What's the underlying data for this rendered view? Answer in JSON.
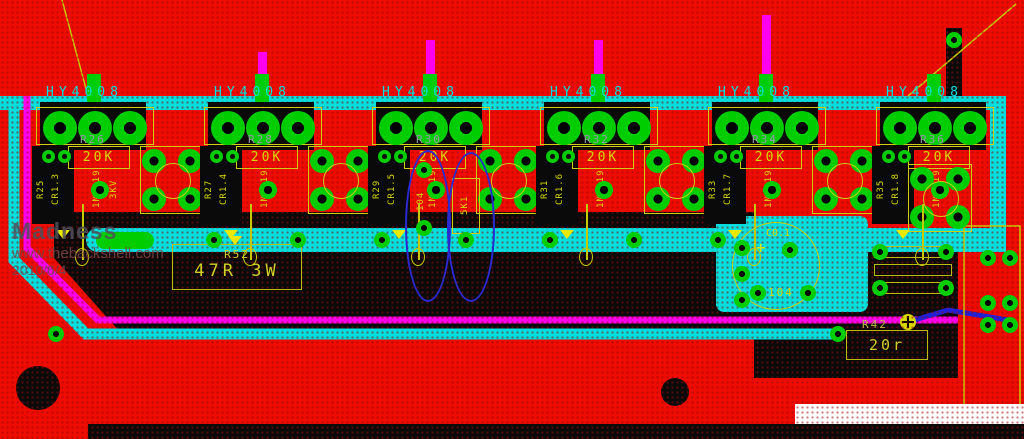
{
  "watermark": {
    "title": "Madness",
    "url": "www.thebackshell.com",
    "date": "2010/6/4"
  },
  "stages": [
    {
      "mosfet": "HY4008",
      "res_ref": "R26",
      "res_val": "20K",
      "vtexts": [
        "R25",
        "CR1.3",
        "1N5819",
        "3KV"
      ]
    },
    {
      "mosfet": "HY4008",
      "res_ref": "R28",
      "res_val": "20K",
      "vtexts": [
        "R27",
        "CR1.4",
        "1N5819",
        ""
      ]
    },
    {
      "mosfet": "HY4008",
      "res_ref": "R30",
      "res_val": "20K",
      "vtexts": [
        "R29",
        "CR1.5",
        "1N5819",
        ""
      ]
    },
    {
      "mosfet": "HY4008",
      "res_ref": "R32",
      "res_val": "20K",
      "vtexts": [
        "R31",
        "CR1.6",
        "1N5819",
        ""
      ]
    },
    {
      "mosfet": "HY4008",
      "res_ref": "R34",
      "res_val": "20K",
      "vtexts": [
        "R33",
        "CR1.7",
        "1N5819",
        ""
      ]
    },
    {
      "mosfet": "HY4008",
      "res_ref": "R36",
      "res_val": "20K",
      "vtexts": [
        "R35",
        "CR1.8",
        "1N5819",
        ""
      ]
    }
  ],
  "components": {
    "r52": {
      "ref": "R52",
      "val": "47R 3W"
    },
    "r42": {
      "ref": "R42",
      "val": "20r"
    },
    "cap": {
      "ref": "C0.1",
      "val": "104",
      "plus": "+"
    },
    "cap104": {
      "val": "104"
    },
    "r5k1": {
      "val": "5K1"
    }
  },
  "colors": {
    "copper_red": "#ee0b00",
    "plane_black": "#0a0a0a",
    "pad_green": "#00cd00",
    "trace_cyan": "#00dede",
    "trace_magenta": "#ff00ee",
    "silk_yellow": "#d8d800",
    "ref_gray": "#9d96ad",
    "highlight_blue": "#2a2ad2"
  }
}
